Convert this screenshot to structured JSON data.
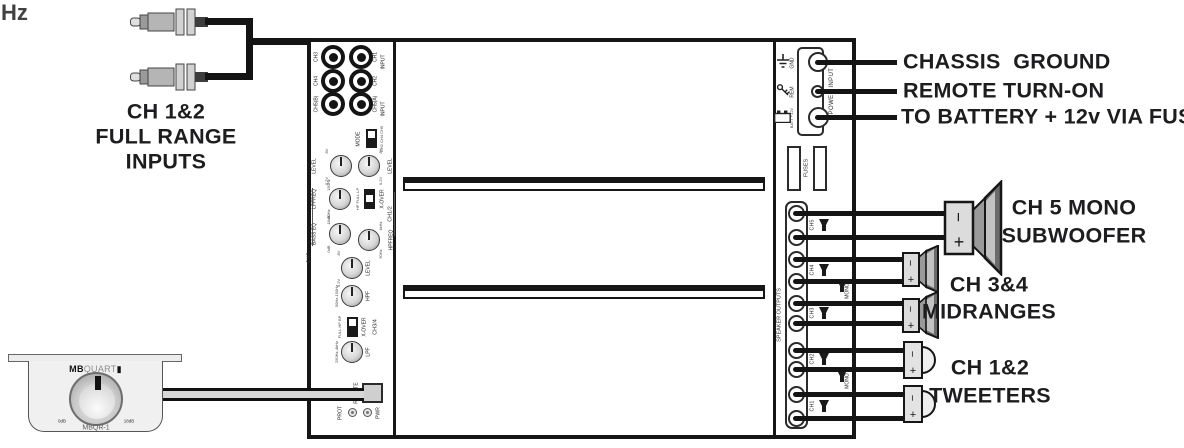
{
  "misc": {
    "hz": "Hz"
  },
  "rca": {
    "label1": "CH 1&2",
    "label2": "FULL RANGE",
    "label3": "INPUTS"
  },
  "amp": {
    "jacks": {
      "left": [
        "CH3",
        "CH4",
        "CH5(B)"
      ],
      "right": [
        "CH1",
        "CH2",
        "CH5(A)"
      ],
      "input": "INPUT"
    },
    "mode": {
      "label": "MODE",
      "options": "CH2 CH4 CH5"
    },
    "level": {
      "label": "LEVEL",
      "min": "0.2V",
      "max": "8V"
    },
    "ch5": {
      "bracket": "CH5",
      "lpfreq": {
        "label": "LPFREQ",
        "min": "30Hz",
        "max": "150Hz"
      },
      "basseq": {
        "label": "BASS EQ",
        "min": "0dB",
        "max": "18dB"
      }
    },
    "ch12": {
      "bracket": "CH1/2",
      "xover": {
        "label": "X-OVER",
        "options": "HP FULL LP"
      },
      "hpfreq": {
        "label": "HPFREQ",
        "min": "50Hz",
        "max": "4kHz"
      }
    },
    "ch34": {
      "bracket": "CH3/4",
      "xover": {
        "label": "X-OVER",
        "options": "FULL HP BP"
      },
      "hpf": {
        "label": "HPF",
        "range": "50Hz-150Hz"
      },
      "lpf": {
        "label": "LPF",
        "range": "250Hz-4kHz"
      }
    },
    "remote_port": "REMOTE",
    "leds": {
      "prot": "PROT",
      "pwr": "PWR"
    },
    "power": {
      "box": "POWER INPUT",
      "gnd": "GND",
      "rem": "REM",
      "batt": "BATT +12V"
    },
    "fuses": "FUSES",
    "outputs": {
      "label": "SPEAKER OUTPUTS",
      "channels": [
        "CH5",
        "CH4",
        "CH3",
        "CH2",
        "CH1"
      ],
      "mono": "MONO",
      "plus": "+",
      "minus": "−"
    }
  },
  "power_labels": {
    "gnd": "CHASSIS  GROUND",
    "rem": "REMOTE TURN-ON",
    "batt": "TO BATTERY + 12v VIA FUSE"
  },
  "speakers": {
    "sub": {
      "l1": "CH 5 MONO",
      "l2": "SUBWOOFER"
    },
    "mid": {
      "l1": "CH 3&4",
      "l2": "MIDRANGES"
    },
    "tw": {
      "l1": "CH 1&2",
      "l2": "TWEETERS"
    },
    "plus": "+",
    "minus": "−"
  },
  "remote": {
    "brand_b": "MB",
    "brand_l": "QUART",
    "block": "▮",
    "min": "0dB",
    "max": "18dB",
    "model": "MBQR-1"
  }
}
